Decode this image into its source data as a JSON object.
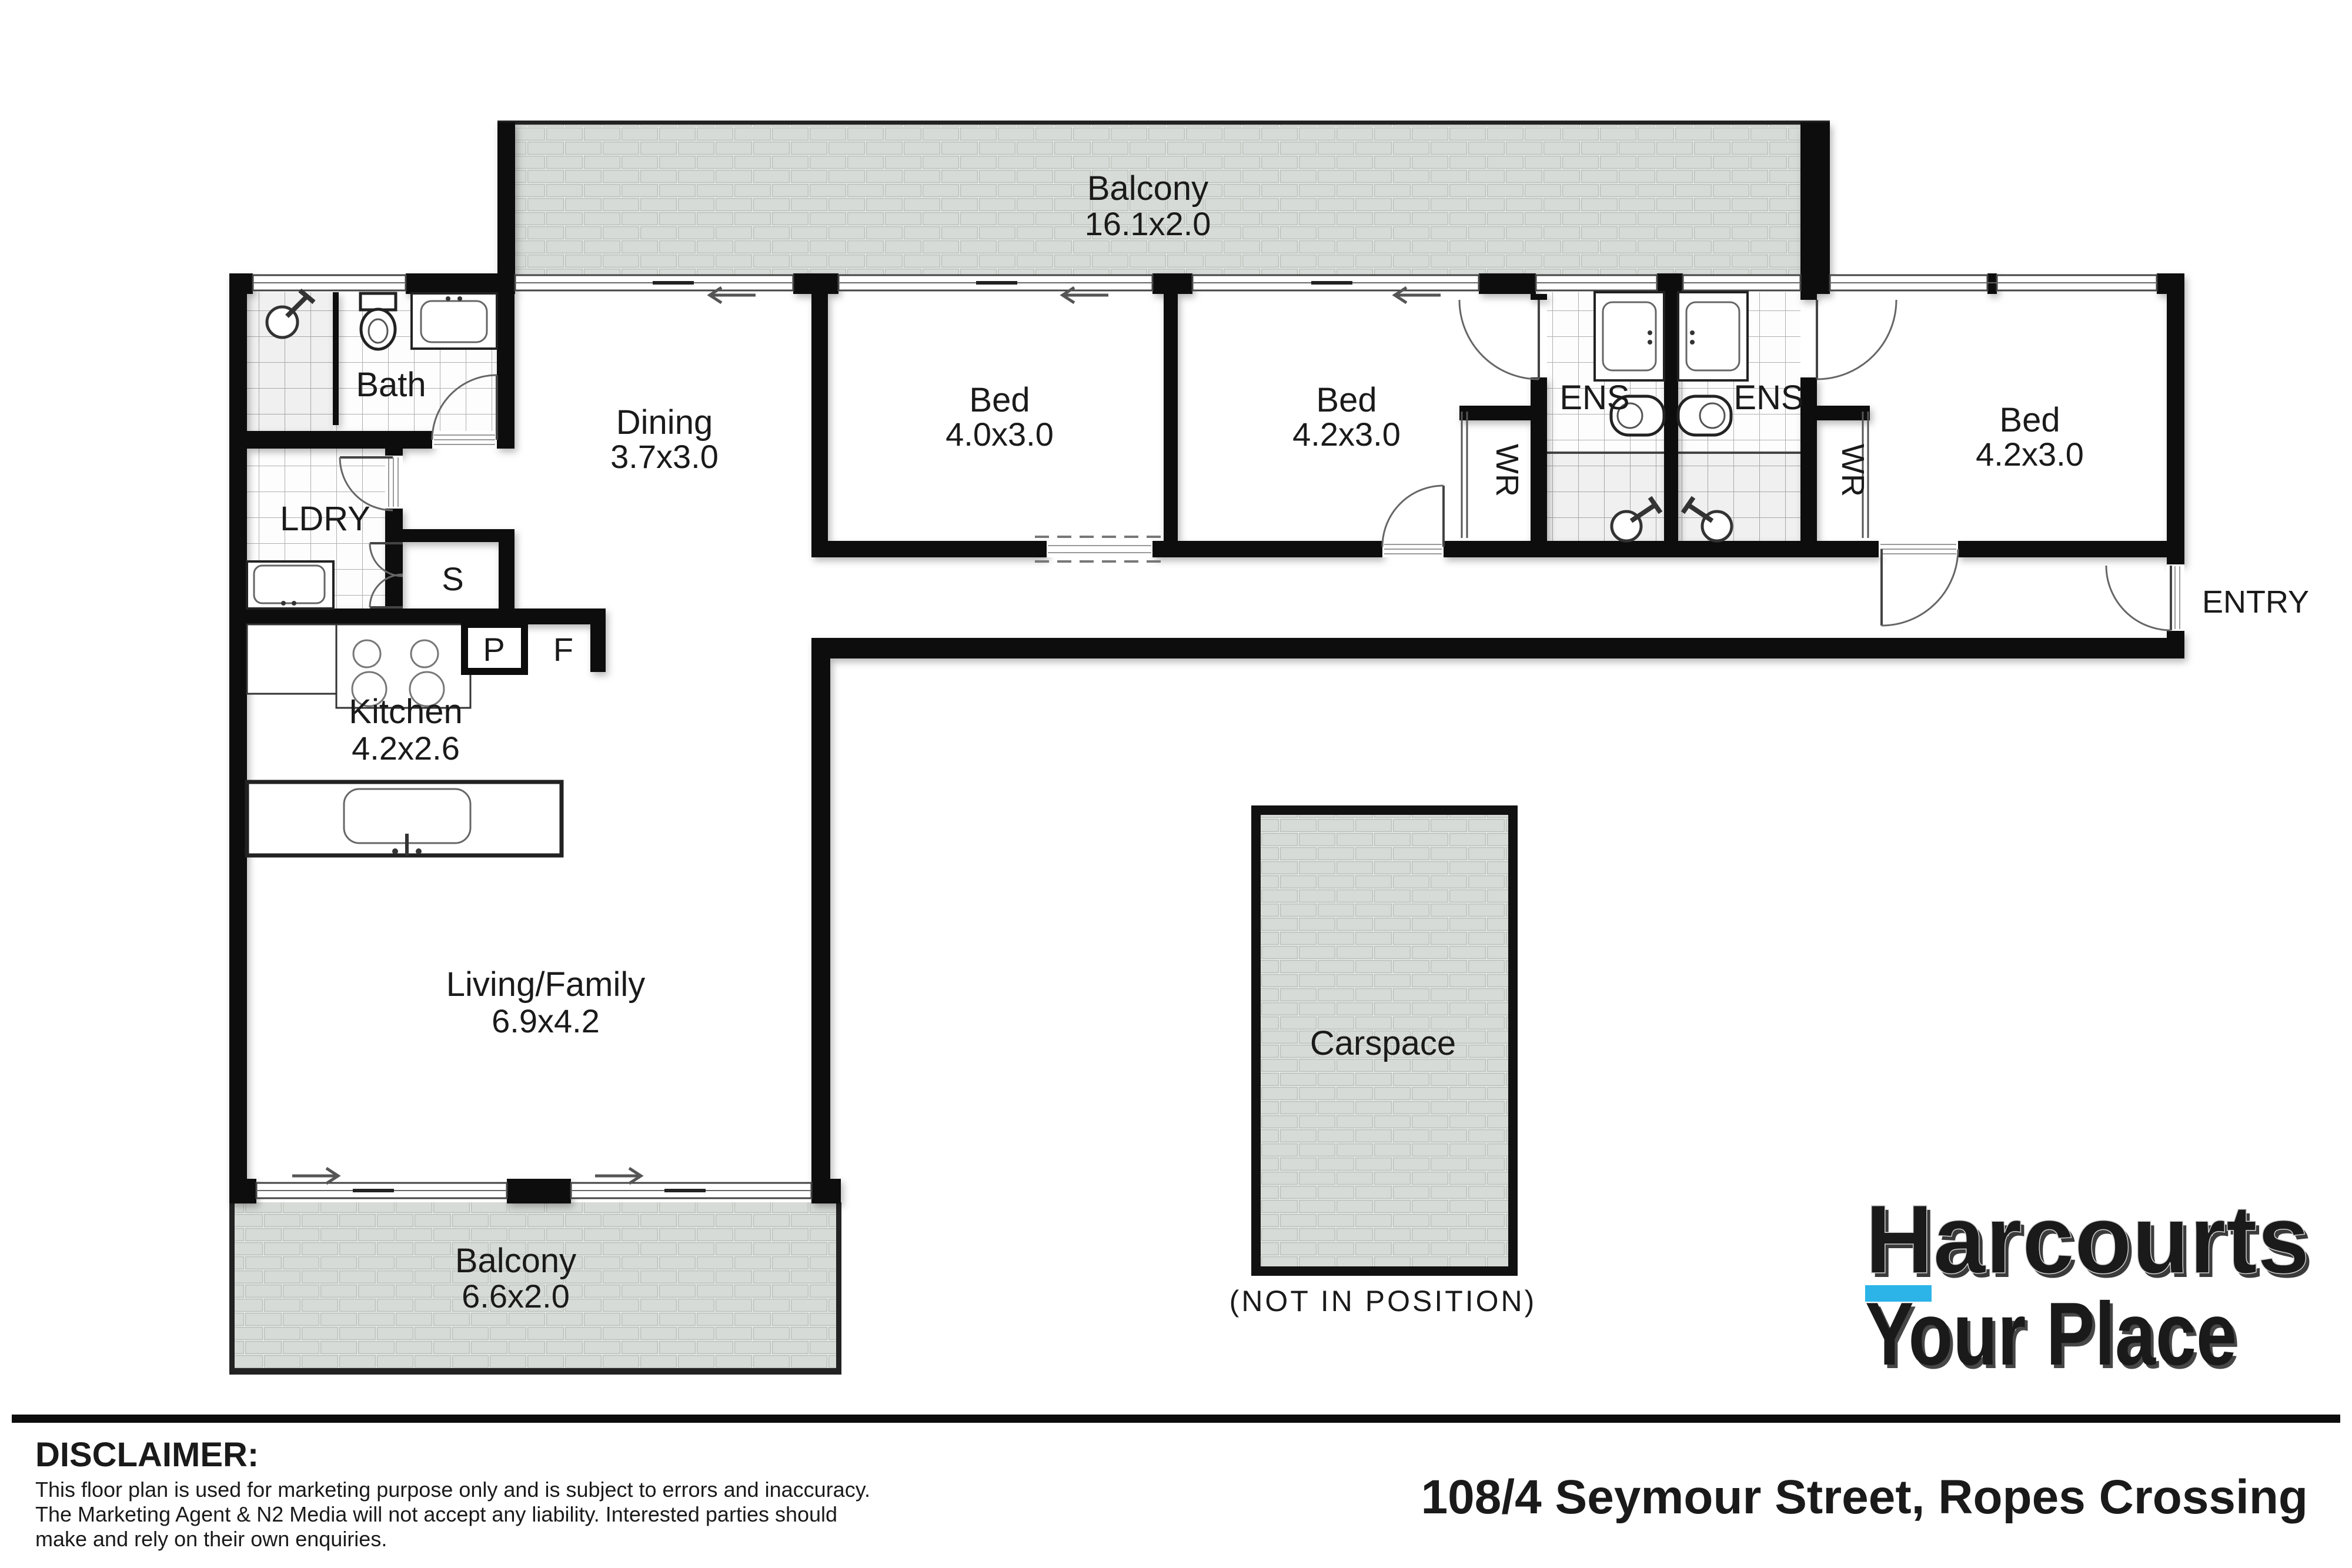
{
  "plan": {
    "rooms": {
      "balcony_top": {
        "name": "Balcony",
        "dims": "16.1x2.0"
      },
      "bath": {
        "name": "Bath"
      },
      "laundry": {
        "name": "LDRY"
      },
      "storage": {
        "name": "S"
      },
      "pantry": {
        "name": "P"
      },
      "fridge": {
        "name": "F"
      },
      "dining": {
        "name": "Dining",
        "dims": "3.7x3.0"
      },
      "bed1": {
        "name": "Bed",
        "dims": "4.0x3.0"
      },
      "bed2": {
        "name": "Bed",
        "dims": "4.2x3.0"
      },
      "ens_left": {
        "name": "ENS"
      },
      "ens_right": {
        "name": "ENS"
      },
      "robe_left": {
        "name": "WR"
      },
      "robe_right": {
        "name": "WR"
      },
      "bed3": {
        "name": "Bed",
        "dims": "4.2x3.0"
      },
      "entry": {
        "name": "ENTRY"
      },
      "kitchen": {
        "name": "Kitchen",
        "dims": "4.2x2.6"
      },
      "living": {
        "name": "Living/Family",
        "dims": "6.9x4.2"
      },
      "balcony_bottom": {
        "name": "Balcony",
        "dims": "6.6x2.0"
      },
      "carspace": {
        "name": "Carspace",
        "note": "(NOT IN POSITION)"
      }
    }
  },
  "branding": {
    "brand": "Harcourts",
    "office": "Your Place",
    "underline_color": "#2cb4e8",
    "brand_color": "#fdfdfd",
    "office_color": "#223e8e"
  },
  "footer": {
    "disclaimer_heading": "DISCLAIMER:",
    "disclaimer_lines": [
      "This floor plan is used for marketing purpose only and is subject to errors and inaccuracy.",
      "The Marketing Agent & N2 Media will not accept any liability. Interested parties should",
      "make and rely on their own enquiries."
    ],
    "address": "108/4 Seymour Street, Ropes Crossing"
  },
  "palette": {
    "wall": "#0c0c0c",
    "brick_fill": "#d7dbd7",
    "brick_mortar": "#eef0ee",
    "tile_line": "#b0b0b0",
    "label": "#1a1a1a"
  }
}
